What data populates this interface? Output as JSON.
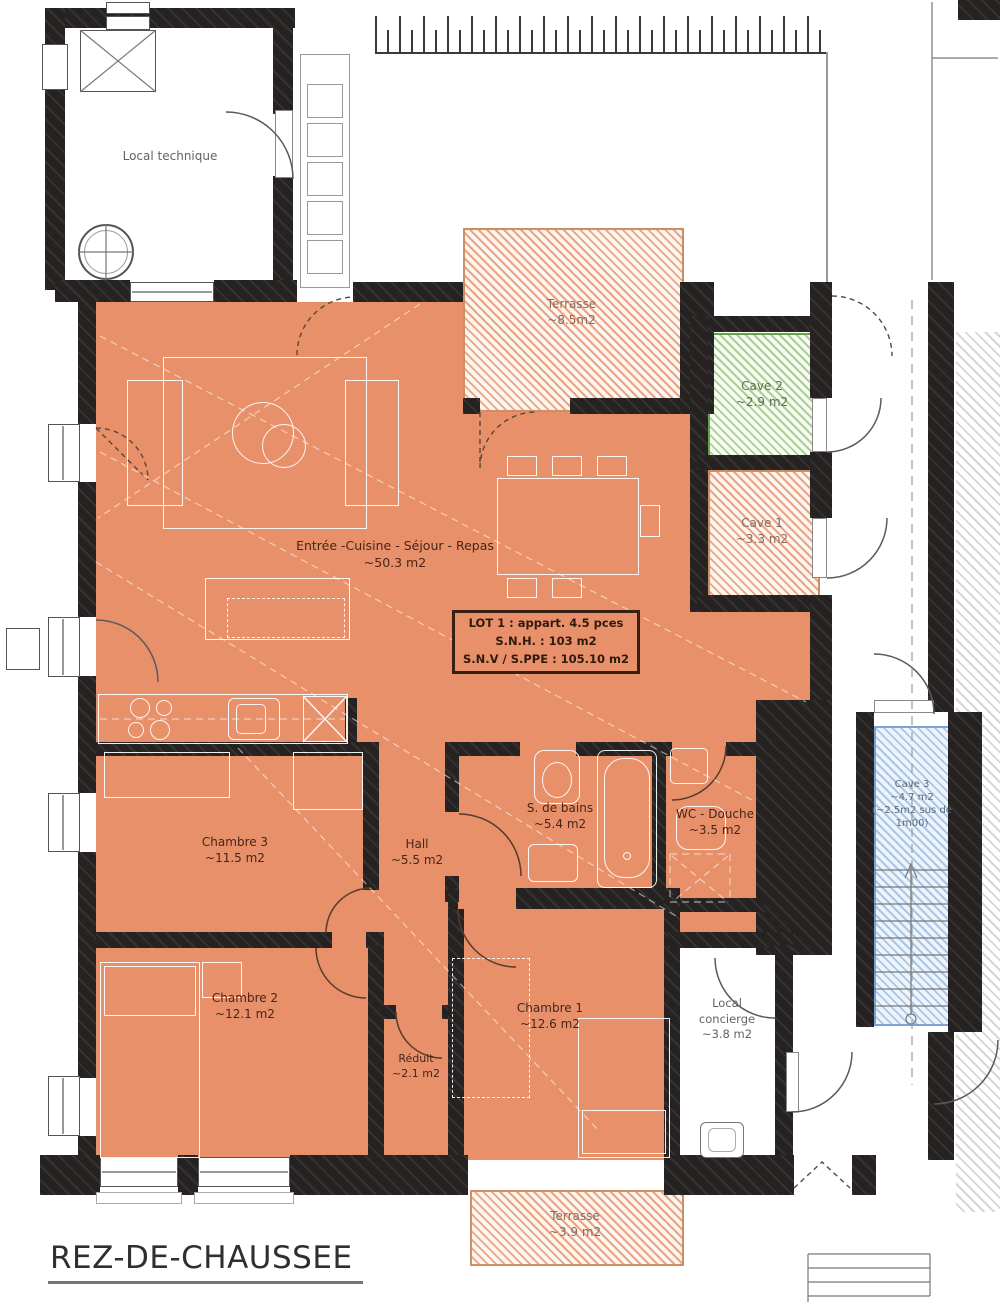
{
  "title": "REZ-DE-CHAUSSEE",
  "rooms": {
    "local_technique": {
      "name": "Local technique"
    },
    "terrasse_top": {
      "name": "Terrasse",
      "area": "~8.5m2"
    },
    "cave2": {
      "name": "Cave 2",
      "area": "~2.9 m2"
    },
    "cave1": {
      "name": "Cave 1",
      "area": "~3.3 m2"
    },
    "sejour": {
      "name": "Entrée -Cuisine - Séjour - Repas",
      "area": "~50.3 m2"
    },
    "chambre3": {
      "name": "Chambre 3",
      "area": "~11.5 m2"
    },
    "hall": {
      "name": "Hall",
      "area": "~5.5 m2"
    },
    "bains": {
      "name": "S. de bains",
      "area": "~5.4 m2"
    },
    "wc": {
      "name": "WC - Douche",
      "area": "~3.5 m2"
    },
    "cave3": {
      "name": "Cave 3",
      "area": "~4.7 m2",
      "note": "(~2.5m2 sus de 1m00)"
    },
    "chambre2": {
      "name": "Chambre 2",
      "area": "~12.1 m2"
    },
    "reduit": {
      "name": "Réduit",
      "area": "~2.1 m2"
    },
    "chambre1": {
      "name": "Chambre 1",
      "area": "~12.6 m2"
    },
    "concierge": {
      "name": "Local concierge",
      "area": "~3.8 m2"
    },
    "terrasse_bottom": {
      "name": "Terrasse",
      "area": "~3.9 m2"
    }
  },
  "lot": {
    "line1": "LOT 1 : appart. 4.5 pces",
    "line2": "S.N.H. : 103 m2",
    "line3": "S.N.V / S.PPE : 105.10 m2"
  },
  "colors": {
    "apartment_fill": "#E8906A",
    "terrace_hatch": "#E9A483",
    "cave_green_hatch": "#67A24B",
    "cave_blue_hatch": "#7BA4D4",
    "wall": "#262222"
  }
}
